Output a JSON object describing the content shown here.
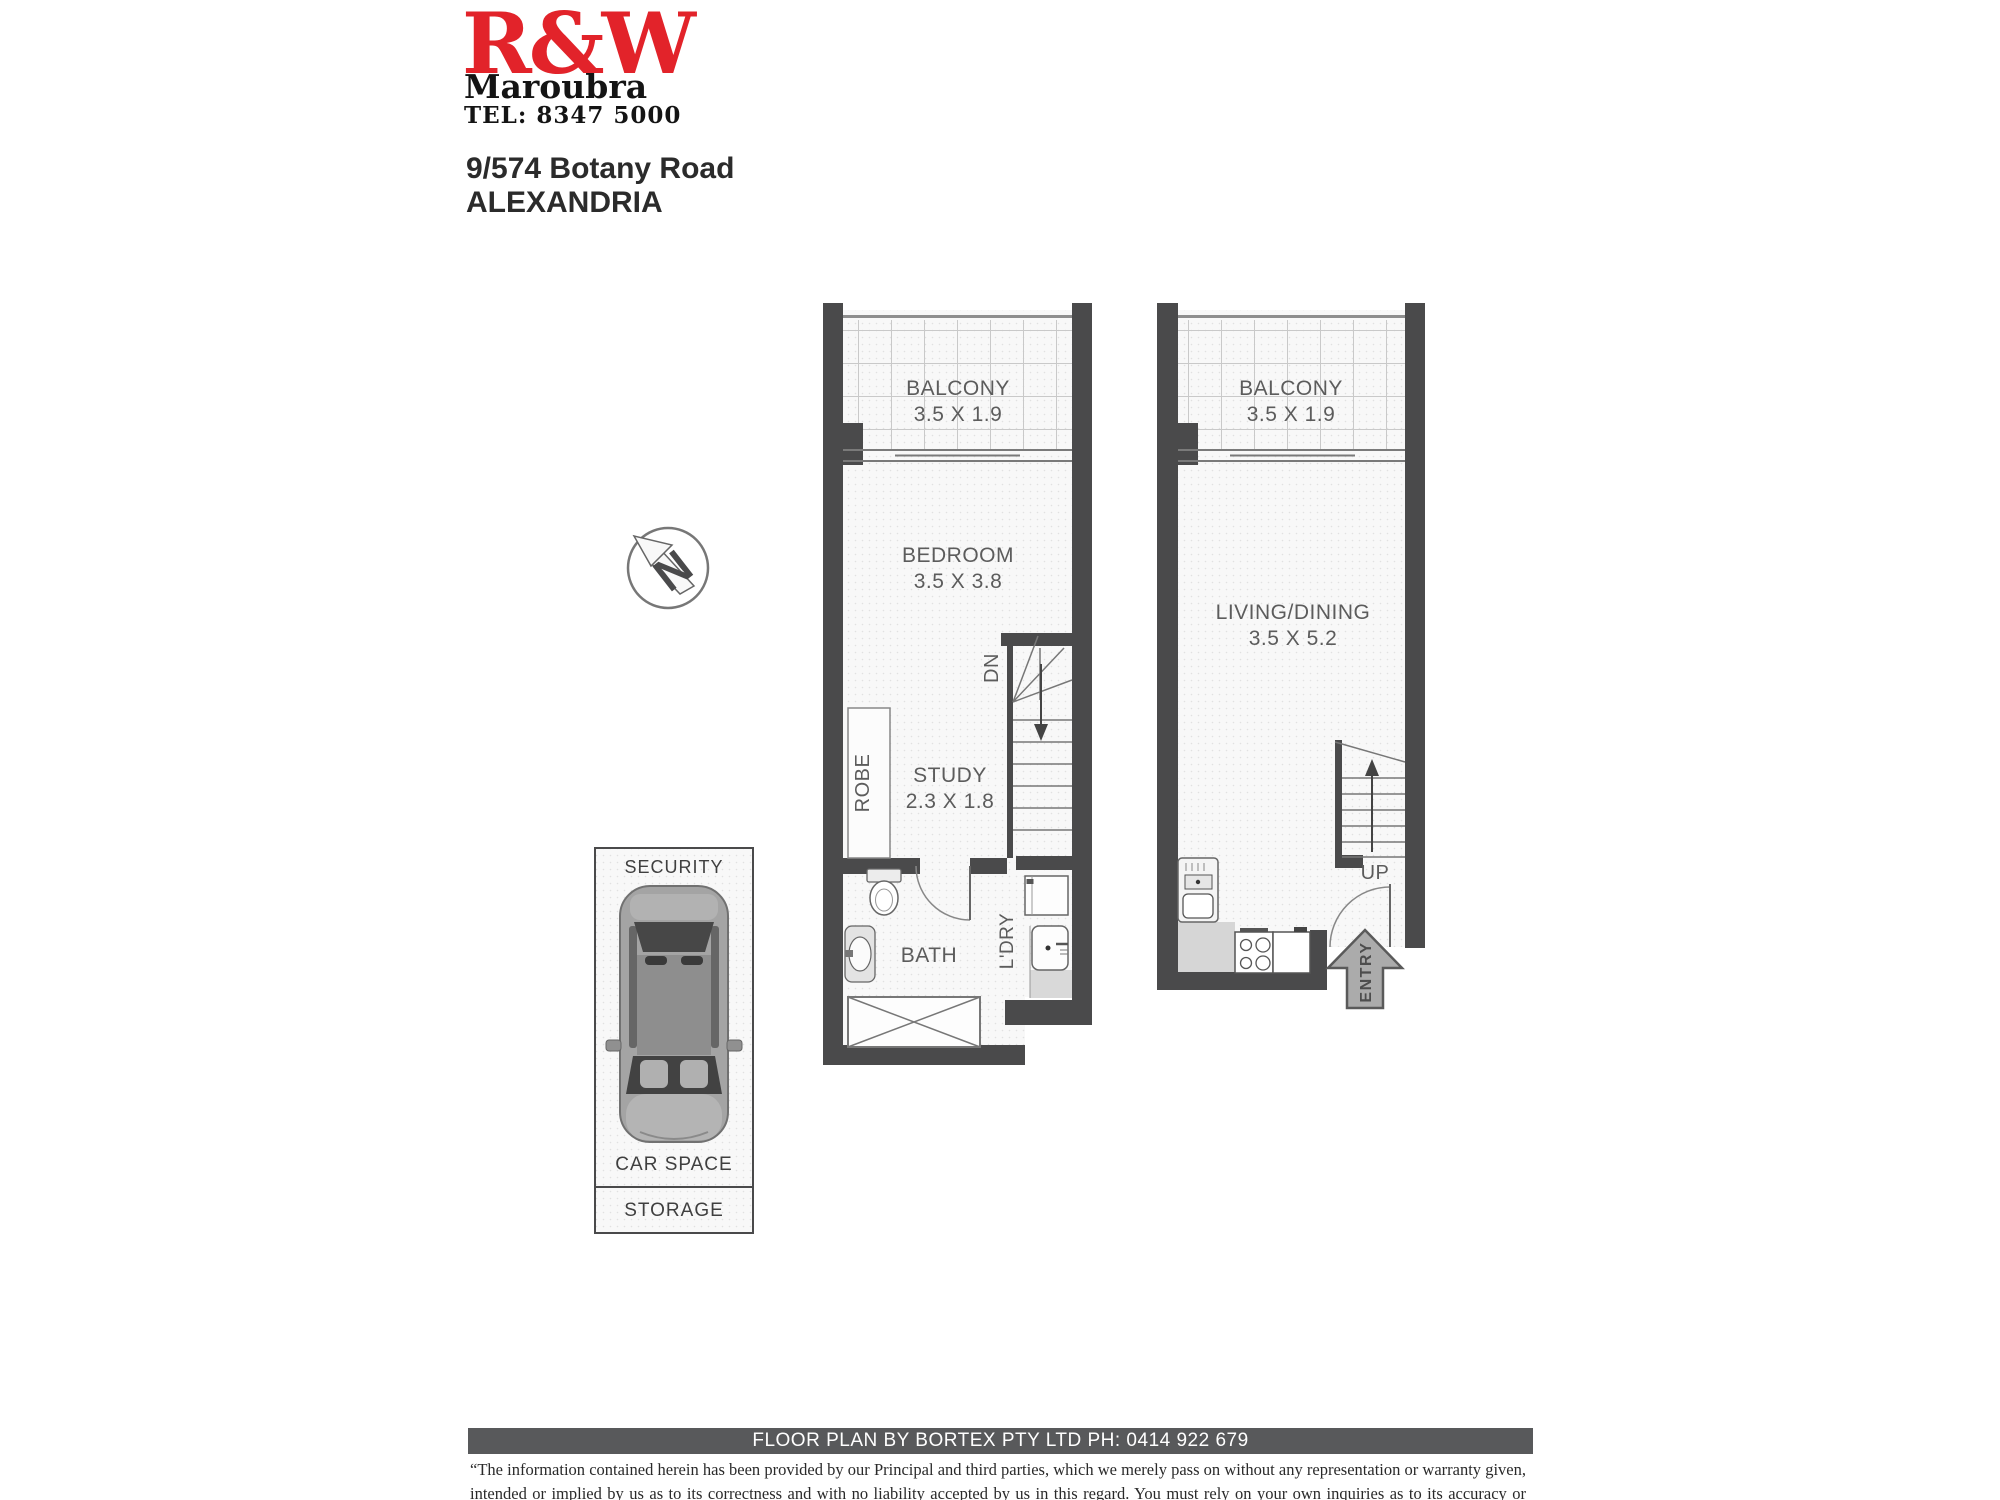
{
  "header": {
    "brand": "R&W",
    "office": "Maroubra",
    "phone": "TEL: 8347 5000"
  },
  "address": {
    "line1": "9/574 Botany Road",
    "line2": "ALEXANDRIA"
  },
  "compass": {
    "letter": "N"
  },
  "level1": {
    "balcony_label": "BALCONY",
    "balcony_dims": "3.5 X 1.9",
    "bedroom_label": "BEDROOM",
    "bedroom_dims": "3.5 X 3.8",
    "study_label": "STUDY",
    "study_dims": "2.3 X 1.8",
    "robe_label": "ROBE",
    "stairs_label": "DN",
    "bath_label": "BATH",
    "laundry_label": "L'DRY"
  },
  "level2": {
    "balcony_label": "BALCONY",
    "balcony_dims": "3.5 X 1.9",
    "living_label": "LIVING/DINING",
    "living_dims": "3.5 X 5.2",
    "stairs_label": "UP",
    "entry_label": "ENTRY"
  },
  "parking": {
    "security_label": "SECURITY",
    "car_space_label": "CAR SPACE",
    "storage_label": "STORAGE"
  },
  "footer": {
    "credit": "FLOOR PLAN BY BORTEX PTY LTD PH: 0414 922 679",
    "disclaimer": "“The information contained herein has been provided by our Principal and third parties, which we merely pass on without any representation or warranty given, intended or implied by us as to its correctness and with no liability accepted by us in this regard. You must rely on your own inquiries as to its accuracy or otherwise.”"
  },
  "colors": {
    "brand_red": "#e2232a",
    "wall": "#4a4a4b",
    "footer_bar": "#58595b"
  }
}
